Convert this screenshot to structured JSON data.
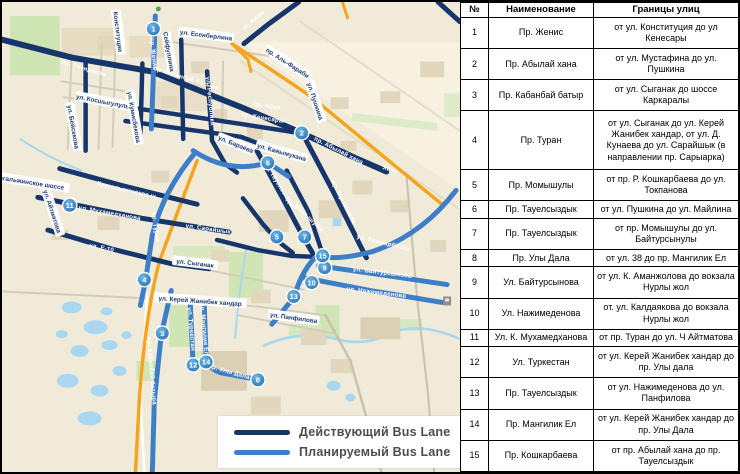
{
  "colors": {
    "active_lane": "#16356b",
    "planned_lane": "#3d7ec9",
    "marker_fill": "#2f7fc0",
    "highway": "#f4a51f",
    "map_bg": "#f0ead9",
    "water": "#a9d7f0",
    "park": "#cfe5b4"
  },
  "legend": {
    "active": "Действующий Bus Lane",
    "planned": "Планируемый Bus Lane"
  },
  "table": {
    "headers": [
      "№",
      "Наименование",
      "Границы улиц"
    ],
    "rows": [
      {
        "num": "1",
        "name": "Пр. Женис",
        "bounds": "от ул. Конституция до ул Кенесары"
      },
      {
        "num": "2",
        "name": "Пр. Абылай хана",
        "bounds": "от ул. Мустафина до ул. Пушкина"
      },
      {
        "num": "3",
        "name": "Пр. Кабанбай батыр",
        "bounds": "от ул. Сыганак до шоссе Каркаралы"
      },
      {
        "num": "4",
        "name": "Пр. Туран",
        "bounds": "от ул. Сыганак до ул. Керей Жанибек хандар, от ул. Д. Кунаева до ул. Сарайшык (в направлении пр. Сарыарка)"
      },
      {
        "num": "5",
        "name": "Пр. Момышулы",
        "bounds": "от пр. Р. Кошкарбаева до ул. Токпанова"
      },
      {
        "num": "6",
        "name": "Пр. Тауелсыздык",
        "bounds": "от ул. Пушкина до ул. Майлина"
      },
      {
        "num": "7",
        "name": "Пр. Тауелсыздык",
        "bounds": "от пр. Момышулы до ул. Байтурсынулы"
      },
      {
        "num": "8",
        "name": "Пр. Улы Дала",
        "bounds": "от ул. 38 до пр. Мангилик Ел"
      },
      {
        "num": "9",
        "name": "Ул. Байтурсынова",
        "bounds": "от ул. К. Аманжолова до вокзала Нурлы жол"
      },
      {
        "num": "10",
        "name": "Ул. Нажимеденова",
        "bounds": "от. ул. Калдаякова до вокзала Нурлы жол"
      },
      {
        "num": "11",
        "name": "Ул. К. Мухамедханова",
        "bounds": "от пр. Туран до ул. Ч Айтматова"
      },
      {
        "num": "12",
        "name": "Ул. Туркестан",
        "bounds": "от ул. Керей Жанибек хандар до пр. Улы дала"
      },
      {
        "num": "13",
        "name": "Пр. Тауелсыздык",
        "bounds": "от ул. Нажимеденова до ул. Панфилова"
      },
      {
        "num": "14",
        "name": "Пр. Мангилик Ел",
        "bounds": "от ул. Керей Жанибек хандар до пр. Улы Дала"
      },
      {
        "num": "15",
        "name": "Пр. Кошкарбаева",
        "bounds": "от пр. Абылай хана до пр. Тауелсыздык"
      }
    ]
  },
  "map": {
    "markers": [
      {
        "n": "1"
      },
      {
        "n": "2"
      },
      {
        "n": "3"
      },
      {
        "n": "4"
      },
      {
        "n": "5"
      },
      {
        "n": "6"
      },
      {
        "n": "7"
      },
      {
        "n": "8"
      },
      {
        "n": "9"
      },
      {
        "n": "10"
      },
      {
        "n": "11"
      },
      {
        "n": "12"
      },
      {
        "n": "13"
      },
      {
        "n": "14"
      },
      {
        "n": "15"
      }
    ],
    "pills": [
      {
        "text": "Конституции"
      },
      {
        "text": "ул. Есенберлина"
      },
      {
        "text": "пр. Аль-Фараби"
      },
      {
        "text": "ул. Пушкина"
      },
      {
        "text": "ул. Косшыгулулы"
      },
      {
        "text": "ул. Кумисбекова"
      },
      {
        "text": "ул. Бейсекова"
      },
      {
        "text": "ул. Айтматова"
      },
      {
        "text": "Коргальжинское шоссе"
      },
      {
        "text": "ул. Сыганак"
      },
      {
        "text": "ул. Керей Жанибек хандар"
      },
      {
        "text": "ул. Панфилова"
      },
      {
        "text": "ул. Бараева"
      },
      {
        "text": "Сейфуллина"
      },
      {
        "text": "ул. Кажымукана"
      }
    ],
    "road_labels": [
      {
        "text": "пр. Тлендиева"
      },
      {
        "text": "пр. Богенбай батыра"
      },
      {
        "text": "ш. Алаш"
      },
      {
        "text": "пр. Женис"
      },
      {
        "text": "пр. Абая"
      },
      {
        "text": "пр. Кенесары"
      },
      {
        "text": "ул. Республики"
      },
      {
        "text": "пр. Абылай хана"
      },
      {
        "text": "Хана"
      },
      {
        "text": "Кургальжинское ш."
      },
      {
        "text": "ул. Мухамедханова"
      },
      {
        "text": "пр. Туран"
      },
      {
        "text": "ул. Сарайшык"
      },
      {
        "text": "ул. Е-10"
      },
      {
        "text": "пр. Тауелсыздык"
      },
      {
        "text": "пр. Момышулы"
      },
      {
        "text": "пр. Жумабаева"
      },
      {
        "text": "ул. Кошкарбаева"
      },
      {
        "text": "ул. Байтурсынова"
      },
      {
        "text": "ул. Нажимеденова"
      },
      {
        "text": "пр. Улы Дала"
      },
      {
        "text": "пр. Кабанбай батыра"
      },
      {
        "text": "ул. Туркестан"
      },
      {
        "text": "пр. Мангилик Ел"
      }
    ]
  }
}
